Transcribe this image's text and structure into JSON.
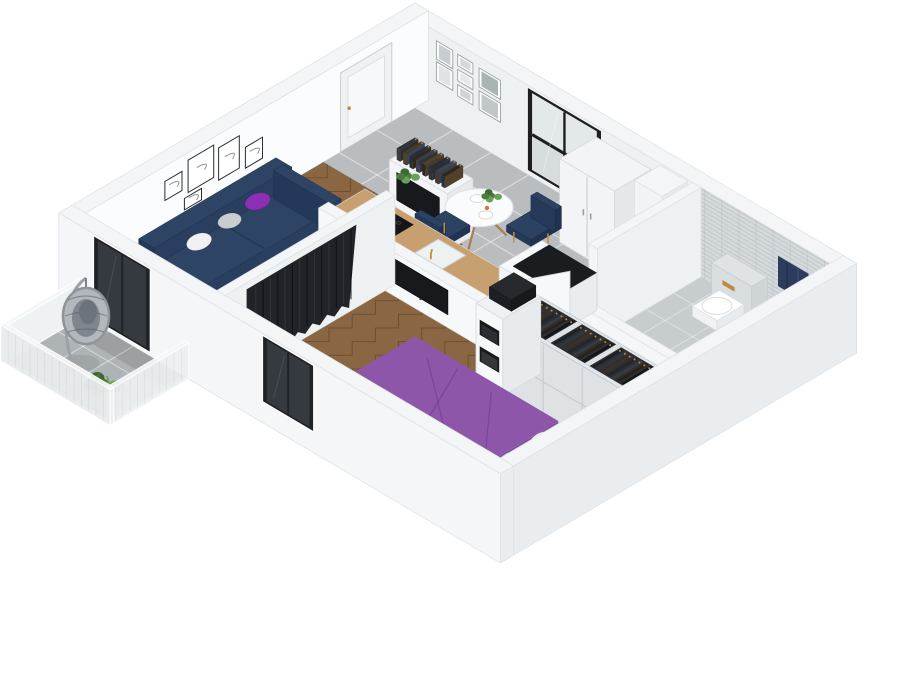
{
  "scene": {
    "kind": "isometric-3d-floorplan-render",
    "background": "#ffffff",
    "description": "3D cutaway floor plan render of a one-bedroom apartment: living room, entry hall, open kitchen-dining, bedroom, bathroom and balcony"
  },
  "palette": {
    "wall_top": "#f3f5f6",
    "wall_stroke": "#dde1e4",
    "int_ne": "#eef1f2",
    "int_nw": "#fbfcfd",
    "ext_sw": "#f4f6f7",
    "ext_se": "#e9edef",
    "floor_wood": "#8a6742",
    "wood_line": "rgba(48,30,14,0.33)",
    "floor_tile": "#b9bdc0",
    "tile_line": "rgba(255,255,255,0.55)",
    "bath_floor": "#c7cccf",
    "bath_tile": "#d4d9db",
    "bath_tile_line": "rgba(120,128,132,0.4)",
    "rug_dark": "#2b2e34",
    "rug_light": "#e7e8ea",
    "sofa_navy": "#2e4464",
    "sofa_shade": "#24385a",
    "pillow_purple": "#8d2fb5",
    "pillow_white": "#eef0f1",
    "pillow_gray": "#c9cdd0",
    "bed_purple": "#8e56a8",
    "bed_purple_deep": "#7a4796",
    "curtain_dark": "#202327",
    "counter_wood": "#c89f6e",
    "cab_white": "#f2f4f5",
    "cab_stroke": "#d6dadd",
    "tv_black": "#17191c",
    "gold": "#c08a3e",
    "plant_green": "#4c7a3f",
    "plant_green2": "#69a257",
    "towel_navy": "#2b3c5d",
    "mesh_panel": "#e9eced",
    "vanity_gray": "#565c63",
    "table_white": "#fafbfc",
    "chair_navy": "#2c4263",
    "box_dark": "#26292d",
    "wood_leg": "#a87f4f",
    "glass_dark": "#343a40",
    "frame_dark": "#2c2e30",
    "photo_gray": "#c6cdd0"
  },
  "rooms": [
    {
      "id": "living-room",
      "floor": "herringbone-wood",
      "furniture": [
        "sofa",
        "rug",
        "coffee-table",
        "media-unit",
        "gallery-wall-5-frames",
        "balcony-door"
      ]
    },
    {
      "id": "entry-hall",
      "floor": "gray-tile",
      "furniture": [
        "front-door",
        "photo-wall-7-frames"
      ]
    },
    {
      "id": "kitchen-dining",
      "floor": "gray-tile",
      "furniture": [
        "window",
        "tall-cabinet",
        "utility-shaft",
        "dining-table",
        "dining-chairs",
        "kitchen-counter",
        "half-wall",
        "peninsula",
        "open-door"
      ]
    },
    {
      "id": "bedroom",
      "floor": "herringbone-wood",
      "furniture": [
        "bed",
        "wardrobe",
        "shelf-unit",
        "wall-tv",
        "curtain",
        "floor-plant",
        "bedroom-window"
      ]
    },
    {
      "id": "bathroom",
      "floor": "tile",
      "furniture": [
        "toilet",
        "towel",
        "washer-cabinet",
        "vanity-sink",
        "bath-mat",
        "tiled-walls"
      ]
    },
    {
      "id": "balcony",
      "floor": "tile",
      "furniture": [
        "hanging-egg-chair",
        "balcony-plant",
        "mesh-railing"
      ]
    }
  ]
}
